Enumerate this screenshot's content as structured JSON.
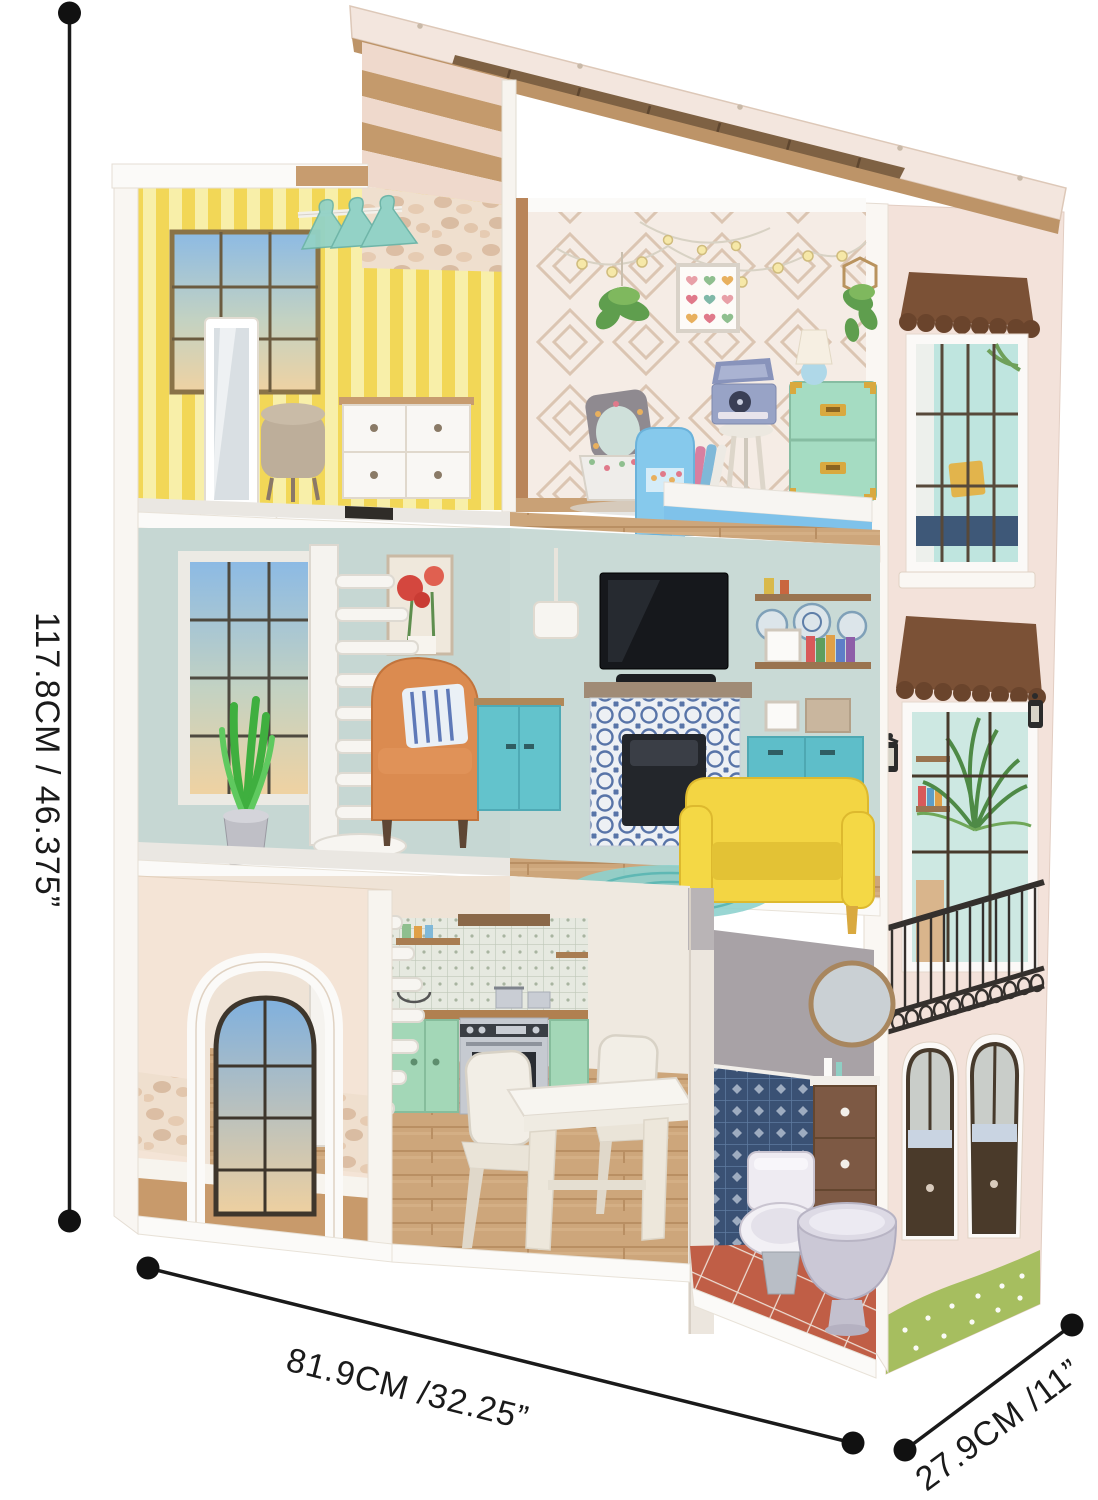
{
  "scene": {
    "description": "Three-story wooden dollhouse product photo with printed dimension lines",
    "view": "cutaway front view with furnished rooms and exterior side wall"
  },
  "annotations": {
    "height": {
      "text": "117.8CM / 46.375”"
    },
    "width": {
      "text": "81.9CM /32.25”"
    },
    "depth": {
      "text": "27.9CM /11”"
    }
  },
  "rooms": {
    "top_left": "wardrobe-room",
    "top_right": "kids-bedroom",
    "middle": "living-room",
    "bottom_left": "kitchen-dining",
    "bottom_right": "bathroom"
  },
  "palette": {
    "dimension_line": "#1a1a1a",
    "roof_cream": "#f3e6de",
    "roof_wood": "#bd9468",
    "yellow_wallpaper": "#f2d757",
    "bedroom_wallpaper": "#f5ece5",
    "living_wall": "#c6d7d3",
    "teal_cabinet": "#5ebec9",
    "mint_cabinet": "#a3d7b7",
    "mint_trunk": "#a5dcc2",
    "yellow_sofa": "#f3d543",
    "orange_chair": "#db8b50",
    "blue_bed": "#86c9ec",
    "wood_floor": "#cda67b",
    "exterior_wall": "#f3e2da",
    "awning_brown": "#7b5136",
    "bath_tile": "#3a5174",
    "terracotta_floor": "#c05e46",
    "grass": "#a6be5f"
  }
}
